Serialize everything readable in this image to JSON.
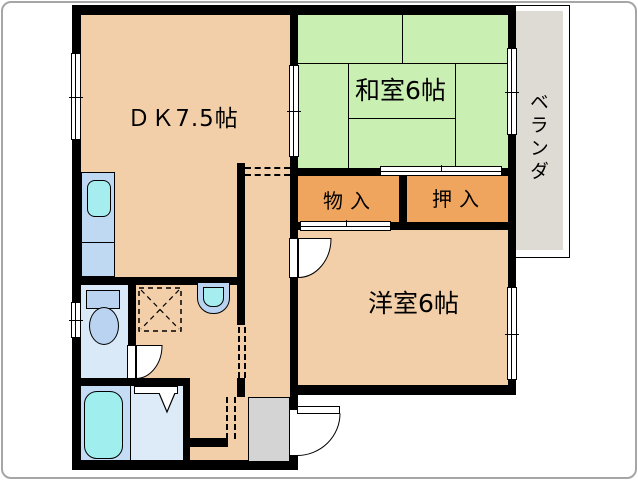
{
  "plan": {
    "labels": {
      "dk": "ＤＫ7.5帖",
      "washitsu": "和室6帖",
      "yoshitsu": "洋室6帖",
      "monoire": "物入",
      "oshiire": "押入",
      "veranda": "ベランダ"
    },
    "colors": {
      "floor": "#F2CFA9",
      "tatami": "#C9EFB2",
      "closet": "#F0A55F",
      "toilet_floor": "#D9E9F8",
      "bath_floor": "#C5DCF5",
      "shower_floor": "#DDEBF9",
      "counter": "#BFD9F2",
      "sink": "#A5EDEF",
      "tub": "#A0EEEE",
      "fixture": "#B9D3F0",
      "cabinet": "#D4D4D4",
      "veranda": "#DEDAD4",
      "wall": "#000000"
    },
    "fixtures": {
      "kitchen_sink": "kitchen-sink",
      "toilet": "toilet",
      "bathtub": "bathtub",
      "washing_machine_pan": "washing-machine-pan",
      "wash_basin": "wash-basin",
      "shoe_cabinet": "shoe-cabinet"
    }
  }
}
